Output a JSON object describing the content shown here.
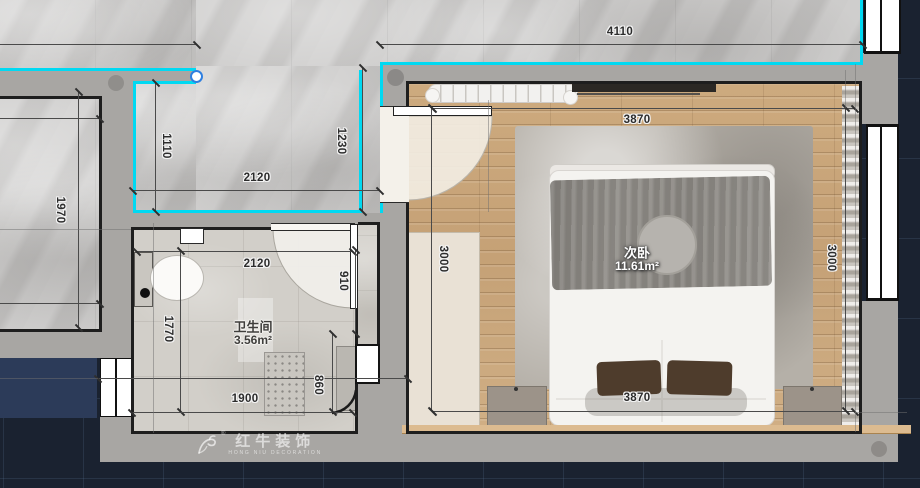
{
  "page": {
    "type": "interior-design-floor-plan"
  },
  "rooms": {
    "bedroom": {
      "name": "次卧",
      "area": "11.61m²"
    },
    "bathroom": {
      "name": "卫生间",
      "area": "3.56m²"
    }
  },
  "dimensions": {
    "total_top": "4110",
    "hallway_width": "1110",
    "hallway_length": "2120",
    "entry_depth": "1230",
    "left_room_depth": "1970",
    "bathroom_width": "2120",
    "bathroom_door_wall": "910",
    "bathroom_depth": "1770",
    "bathroom_bottom_width": "1900",
    "shower_width": "860",
    "bedroom_width_top": "3870",
    "bedroom_depth_left": "3000",
    "bedroom_depth_right": "3000",
    "bedroom_width_bottom": "3870"
  },
  "watermark": {
    "brand": "红牛装饰",
    "subtitle": "HONG NIU DECORATION",
    "registered": "®"
  },
  "colors": {
    "highlight_cyan": "#00d9f2",
    "wall_gray": "#a8a6a3",
    "background_navy": "#1a2230",
    "wood_floor": "#c9a77b",
    "marble": "#c7c6c5",
    "bed_white": "#f4f3f0",
    "blanket_gray": "#8f8c87"
  }
}
